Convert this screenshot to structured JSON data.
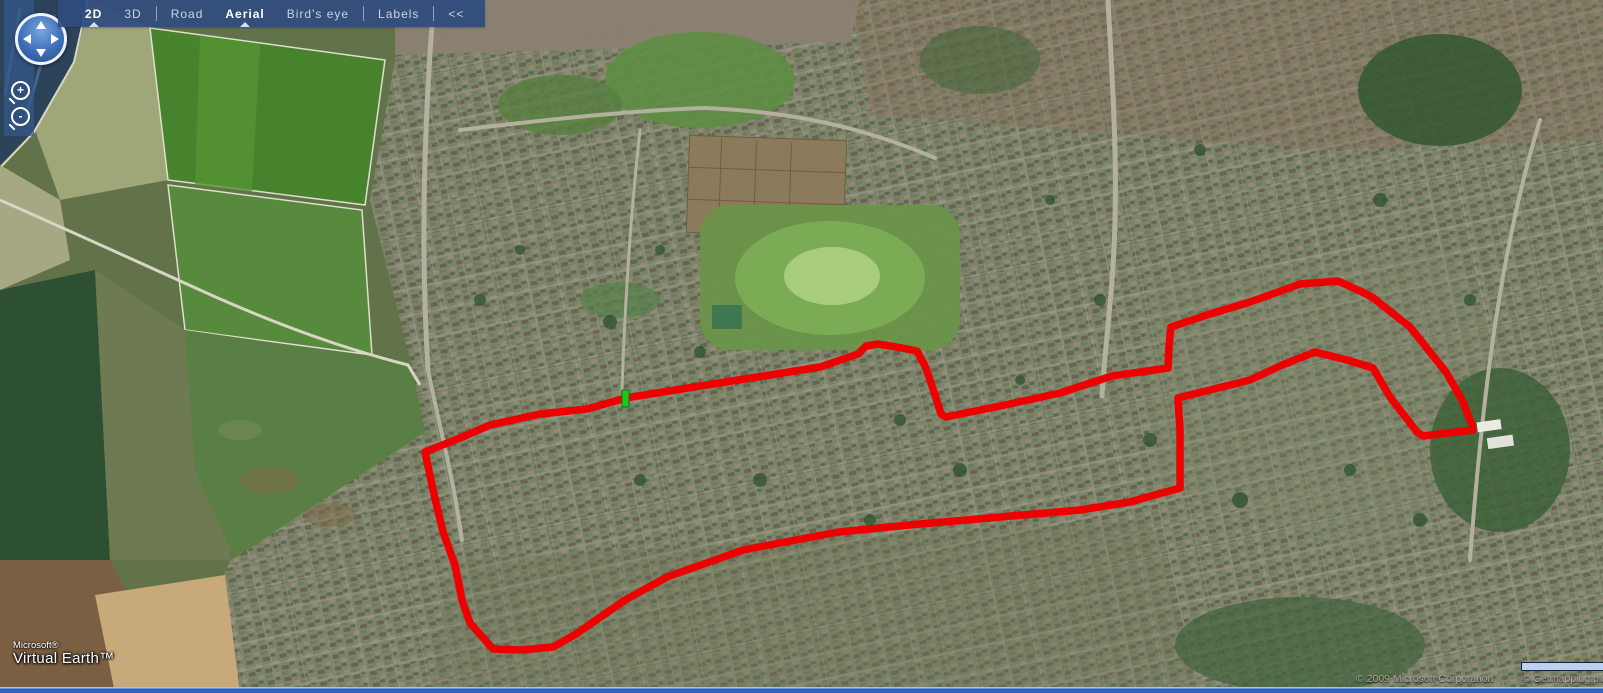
{
  "app": {
    "name": "Microsoft Virtual Earth"
  },
  "toolbar": {
    "background": "#2f4c7e",
    "items": [
      {
        "label": "2D",
        "bold": true,
        "selected": true
      },
      {
        "label": "3D",
        "bold": false,
        "selected": false
      },
      {
        "label": "Road",
        "bold": false,
        "selected": false
      },
      {
        "label": "Aerial",
        "bold": true,
        "selected": true
      },
      {
        "label": "Bird's eye",
        "bold": false,
        "selected": false
      },
      {
        "label": "Labels",
        "bold": false,
        "selected": false
      },
      {
        "label": "<<",
        "bold": false,
        "selected": false
      }
    ]
  },
  "nav": {
    "pan_directions": [
      "up",
      "down",
      "left",
      "right"
    ],
    "zoom_in_label": "+",
    "zoom_out_label": "-"
  },
  "logo": {
    "line1": "Microsoft®",
    "line2": "Virtual Earth™"
  },
  "attribution": {
    "copyrights": [
      "© 2009 Microsoft Corporation",
      "© Getmapping plc",
      "© 200"
    ]
  },
  "map": {
    "view_mode": "Aerial 2D",
    "route": {
      "color": "#ee0000",
      "width": 7.5,
      "points": [
        [
          626,
          398
        ],
        [
          700,
          386
        ],
        [
          770,
          375
        ],
        [
          820,
          367
        ],
        [
          858,
          354
        ],
        [
          866,
          346
        ],
        [
          878,
          344
        ],
        [
          902,
          348
        ],
        [
          917,
          351
        ],
        [
          926,
          368
        ],
        [
          934,
          392
        ],
        [
          941,
          414
        ],
        [
          946,
          417
        ],
        [
          1000,
          406
        ],
        [
          1060,
          393
        ],
        [
          1112,
          376
        ],
        [
          1168,
          368
        ],
        [
          1169,
          345
        ],
        [
          1171,
          327
        ],
        [
          1210,
          314
        ],
        [
          1250,
          302
        ],
        [
          1300,
          284
        ],
        [
          1338,
          281
        ],
        [
          1360,
          291
        ],
        [
          1372,
          297
        ],
        [
          1410,
          327
        ],
        [
          1446,
          372
        ],
        [
          1462,
          400
        ],
        [
          1472,
          425
        ],
        [
          1473,
          430
        ],
        [
          1423,
          436
        ],
        [
          1417,
          432
        ],
        [
          1390,
          397
        ],
        [
          1373,
          368
        ],
        [
          1347,
          360
        ],
        [
          1315,
          352
        ],
        [
          1282,
          365
        ],
        [
          1250,
          380
        ],
        [
          1210,
          390
        ],
        [
          1178,
          398
        ],
        [
          1180,
          430
        ],
        [
          1180,
          488
        ],
        [
          1130,
          502
        ],
        [
          1080,
          510
        ],
        [
          1000,
          517
        ],
        [
          920,
          524
        ],
        [
          838,
          532
        ],
        [
          780,
          543
        ],
        [
          743,
          550
        ],
        [
          667,
          577
        ],
        [
          625,
          600
        ],
        [
          576,
          634
        ],
        [
          553,
          647
        ],
        [
          520,
          650
        ],
        [
          493,
          649
        ],
        [
          470,
          623
        ],
        [
          462,
          600
        ],
        [
          455,
          565
        ],
        [
          443,
          532
        ],
        [
          433,
          490
        ],
        [
          425,
          452
        ],
        [
          460,
          438
        ],
        [
          490,
          425
        ],
        [
          540,
          414
        ],
        [
          587,
          409
        ],
        [
          626,
          398
        ]
      ]
    },
    "start_marker": {
      "color": "#1ec51e",
      "border": "#0a7a0a",
      "x": 622,
      "y": 390,
      "width": 7,
      "height": 17
    }
  }
}
